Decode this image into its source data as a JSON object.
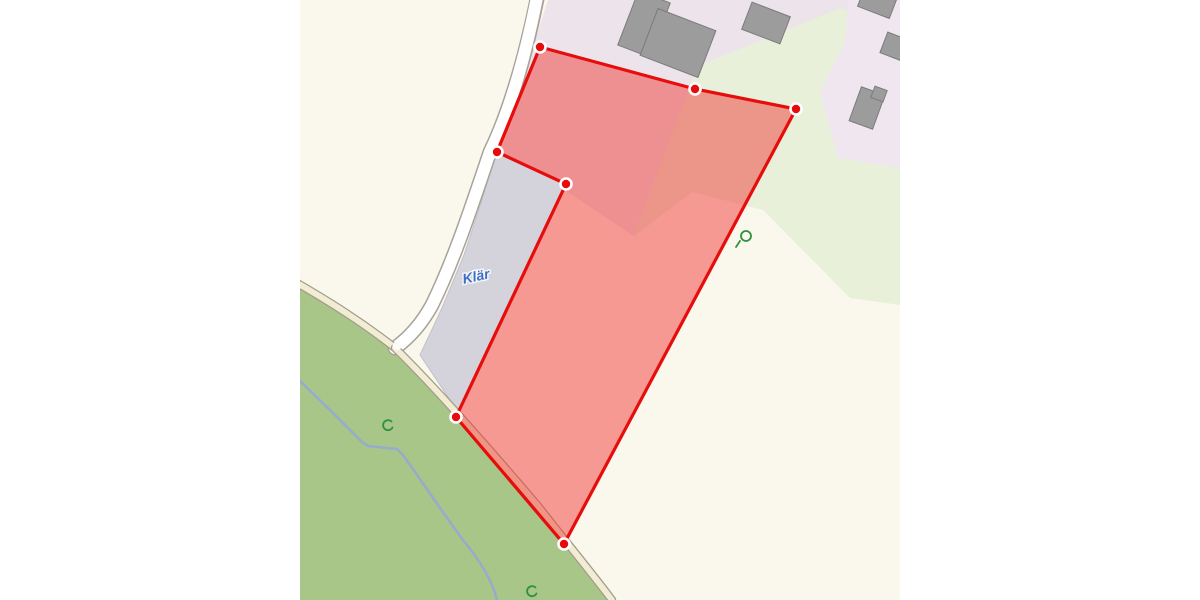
{
  "map": {
    "label_klaer": "Klär",
    "colors": {
      "margin": "#ffffff",
      "farmland": "#faf7ec",
      "residential": "#ece3eb",
      "residential_ne": "#f0e6ef",
      "scrub_green": "#e9f0da",
      "meadow": "#a8c688",
      "parcel_gray": "#d4d2da",
      "road_fill": "#ffffff",
      "road_casing": "#a8a29a",
      "track_fill": "#f1ecd2",
      "track_casing": "#a19c8e",
      "stream": "#96abce",
      "building_fill": "#9c9c9c",
      "building_stroke": "#7b7b7b",
      "symbol_green": "#2f9140",
      "label_blue": "#3b6fc7",
      "selection_red": "#e60d0c"
    },
    "regions": [
      {
        "name": "farmland-base",
        "fill": "#faf7ec",
        "points": "0,0 600,0 600,600 0,600"
      },
      {
        "name": "residential-area",
        "fill": "#ece3eb",
        "points": "248,0 600,0 600,55 520,20 400,66 335,237 265,190 199,160 215,105 232,50"
      },
      {
        "name": "scrub-area",
        "fill": "#e9f0da",
        "points": "398,66 475,35 540,8 600,30 600,305 550,298 463,210 392,192 333,237"
      },
      {
        "name": "residential-area-ne",
        "fill": "#f0e6ef",
        "points": "548,0 600,0 600,168 538,158 520,92 545,42"
      },
      {
        "name": "meadow-area",
        "fill": "#a8c688",
        "points": "-5,286 45,314 80,336 100,352 136,390 182,440 238,506 290,570 314,600 -5,600"
      },
      {
        "name": "treatment-plant-parcel",
        "fill": "#d4d2da",
        "stroke": "#c3c0ca",
        "stroke_width": 1,
        "points": "197,152 266,184 158,412 120,355 142,308 164,255 181,203 193,162"
      }
    ],
    "ways": [
      {
        "name": "stream",
        "stroke": "#96abce",
        "width": 2.5,
        "d": "M 0,381 C 20,400 43,423 62,442 L 68,446 L 97,449 L 103,455 C 123,483 143,513 163,540 C 182,563 193,583 197,600"
      },
      {
        "name": "road-casing",
        "stroke": "#a8a29a",
        "width": 15,
        "d": "M 238,-6 C 225,60 208,115 190,152 C 172,205 155,258 132,305 C 120,327 106,340 95,348"
      },
      {
        "name": "road-fill",
        "stroke": "#ffffff",
        "width": 12,
        "d": "M 238,-8 C 225,60 208,115 190,152 C 172,205 155,258 132,305 C 120,327 106,340 95,348"
      },
      {
        "name": "track-west-casing",
        "stroke": "#a19c8e",
        "width": 8.5,
        "d": "M -8,280 C 30,302 62,322 95,348"
      },
      {
        "name": "track-west-fill",
        "stroke": "#f1ecd2",
        "width": 6,
        "d": "M -8,280 C 30,302 62,322 95,348"
      },
      {
        "name": "track-south-casing",
        "stroke": "#a19c8e",
        "width": 8.5,
        "d": "M 95,348 C 130,382 180,438 238,506 C 262,537 288,568 312,600"
      },
      {
        "name": "track-south-fill",
        "stroke": "#f1ecd2",
        "width": 6,
        "d": "M 95,348 C 130,382 180,438 238,506 C 262,537 288,568 312,600"
      }
    ],
    "junction": {
      "x": 97,
      "y": 346,
      "r": 4.5,
      "fill": "#fbfaf4"
    },
    "buildings": [
      {
        "cx": 344,
        "cy": 24,
        "w": 34,
        "h": 58,
        "angle": 21
      },
      {
        "cx": 378,
        "cy": 43,
        "w": 62,
        "h": 50,
        "angle": 21
      },
      {
        "cx": 466,
        "cy": 23,
        "w": 41,
        "h": 29,
        "angle": 21
      },
      {
        "cx": 577,
        "cy": 3,
        "w": 34,
        "h": 20,
        "angle": 21
      },
      {
        "cx": 596,
        "cy": 47,
        "w": 26,
        "h": 22,
        "angle": 21
      },
      {
        "cx": 567,
        "cy": 108,
        "w": 25,
        "h": 36,
        "angle": 20
      },
      {
        "cx": 579,
        "cy": 94,
        "w": 13,
        "h": 12,
        "angle": 20
      }
    ],
    "symbols": [
      {
        "name": "scrub-symbol",
        "stroke": "#2f9140",
        "width": 1.8,
        "d": "M 91.5,421.5 A 5,5 0 1 0 92.5,427.5"
      },
      {
        "name": "scrub-symbol",
        "stroke": "#2f9140",
        "width": 1.8,
        "d": "M 235.5,587.5 A 5,5 0 1 0 236.5,593.5"
      },
      {
        "name": "tree-curl-symbol-loop",
        "stroke": "#2f9140",
        "width": 1.8,
        "d": "M 441,236 a 5,5 0 1 0 10,0 a 5,5 0 1 0 -10,0"
      },
      {
        "name": "tree-curl-symbol-tail",
        "stroke": "#2f9140",
        "width": 1.8,
        "d": "M 436,247 L 440,241"
      }
    ],
    "label": {
      "x": 177,
      "y": 281,
      "angle": -12,
      "size": 14,
      "fill": "#3b6fc7",
      "halo": "rgba(255,255,255,0.75)"
    },
    "selection": {
      "stroke": "#e60d0c",
      "stroke_width": 3.2,
      "fill": "rgba(240,60,55,0.5)",
      "vertices": [
        [
          240,
          47
        ],
        [
          395,
          89
        ],
        [
          496,
          109
        ],
        [
          264,
          544
        ],
        [
          156,
          417
        ],
        [
          266,
          184
        ],
        [
          197,
          152
        ]
      ],
      "marker": {
        "outer_r": 6.8,
        "outer_fill": "#ffffff",
        "inner_r": 4.2,
        "inner_fill": "#e60c0b"
      }
    }
  }
}
